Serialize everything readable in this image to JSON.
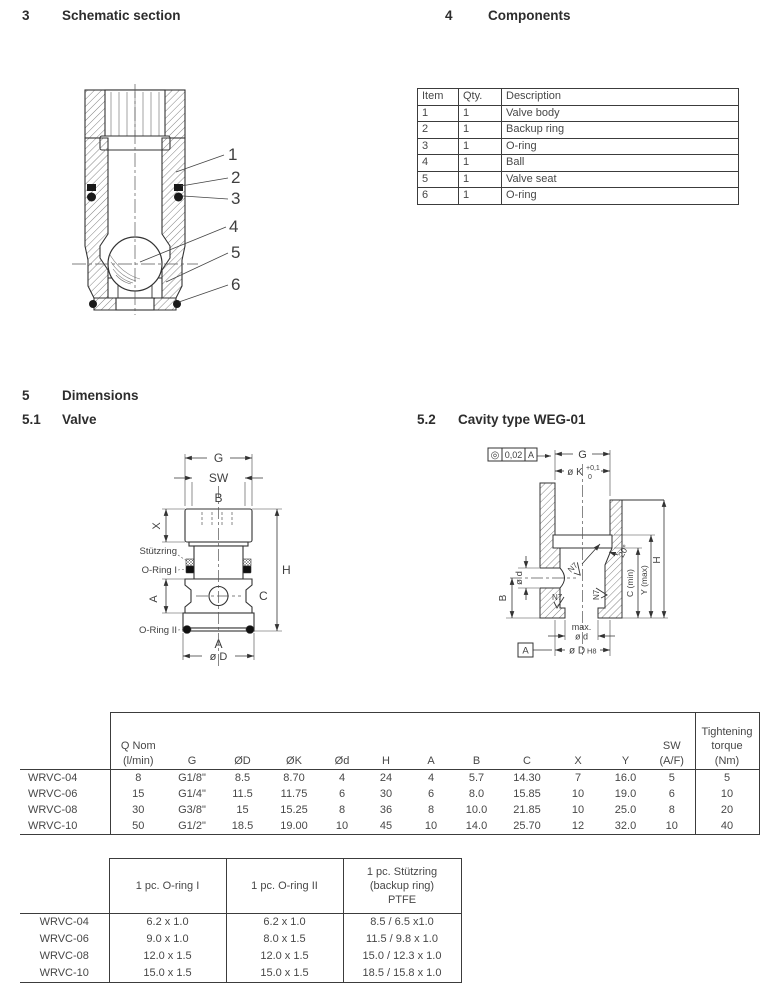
{
  "headings": {
    "s3_num": "3",
    "s3_title": "Schematic section",
    "s4_num": "4",
    "s4_title": "Components",
    "s5_num": "5",
    "s5_title": "Dimensions",
    "s51_num": "5.1",
    "s51_title": "Valve",
    "s52_num": "5.2",
    "s52_title": "Cavity type WEG-01"
  },
  "components": {
    "headers": [
      "Item",
      "Qty.",
      "Description"
    ],
    "rows": [
      [
        "1",
        "1",
        "Valve body"
      ],
      [
        "2",
        "1",
        "Backup ring"
      ],
      [
        "3",
        "1",
        "O-ring"
      ],
      [
        "4",
        "1",
        "Ball"
      ],
      [
        "5",
        "1",
        "Valve seat"
      ],
      [
        "6",
        "1",
        "O-ring"
      ]
    ]
  },
  "schematic": {
    "callouts": [
      "1",
      "2",
      "3",
      "4",
      "5",
      "6"
    ]
  },
  "valve_drawing": {
    "g": "G",
    "sw": "SW",
    "b": "B",
    "x": "X",
    "stutzring": "Stützring",
    "oring1": "O-Ring I",
    "a_side": "A",
    "c": "C",
    "h": "H",
    "oring2": "O-Ring II",
    "a_bottom": "A",
    "o_d": "ø D"
  },
  "cavity_drawing": {
    "tol_symbol": "◎",
    "tol_value": "0,02",
    "tol_datum": "A",
    "g": "G",
    "ok": "ø K",
    "ok_up": "+0,1",
    "ok_dn": "0",
    "od_port": "ø d",
    "b": "B",
    "n7": "N7",
    "angle": "20°",
    "c_min": "C (min)",
    "y_max": "Y (max)",
    "h": "H",
    "max_line1": "max.",
    "max_line2": "ø d",
    "datum": "A",
    "odh8": "ø D",
    "h8": "H8"
  },
  "dimensions_table": {
    "headers": [
      "Q Nom\n(l/min)",
      "G",
      "ØD",
      "ØK",
      "Ød",
      "H",
      "A",
      "B",
      "C",
      "X",
      "Y",
      "SW\n(A/F)",
      "Tightening\ntorque\n(Nm)"
    ],
    "rows": [
      [
        "WRVC-04",
        "8",
        "G1/8\"",
        "8.5",
        "8.70",
        "4",
        "24",
        "4",
        "5.7",
        "14.30",
        "7",
        "16.0",
        "5",
        "5"
      ],
      [
        "WRVC-06",
        "15",
        "G1/4\"",
        "11.5",
        "11.75",
        "6",
        "30",
        "6",
        "8.0",
        "15.85",
        "10",
        "19.0",
        "6",
        "10"
      ],
      [
        "WRVC-08",
        "30",
        "G3/8\"",
        "15",
        "15.25",
        "8",
        "36",
        "8",
        "10.0",
        "21.85",
        "10",
        "25.0",
        "8",
        "20"
      ],
      [
        "WRVC-10",
        "50",
        "G1/2\"",
        "18.5",
        "19.00",
        "10",
        "45",
        "10",
        "14.0",
        "25.70",
        "12",
        "32.0",
        "10",
        "40"
      ]
    ]
  },
  "seals_table": {
    "headers": [
      "1 pc. O-ring I",
      "1 pc. O-ring II",
      "1 pc. Stützring\n(backup ring)\nPTFE"
    ],
    "rows": [
      [
        "WRVC-04",
        "6.2 x 1.0",
        "6.2 x 1.0",
        "8.5 / 6.5 x1.0"
      ],
      [
        "WRVC-06",
        "9.0 x 1.0",
        "8.0 x 1.5",
        "11.5 / 9.8 x 1.0"
      ],
      [
        "WRVC-08",
        "12.0 x 1.5",
        "12.0 x 1.5",
        "15.0 / 12.3 x 1.0"
      ],
      [
        "WRVC-10",
        "15.0 x 1.5",
        "15.0 x 1.5",
        "18.5 / 15.8 x 1.0"
      ]
    ]
  },
  "colors": {
    "text": "#3f3f3f",
    "line": "#333333",
    "border": "#3c3c3c",
    "fill_dark": "#1a1a1a"
  }
}
